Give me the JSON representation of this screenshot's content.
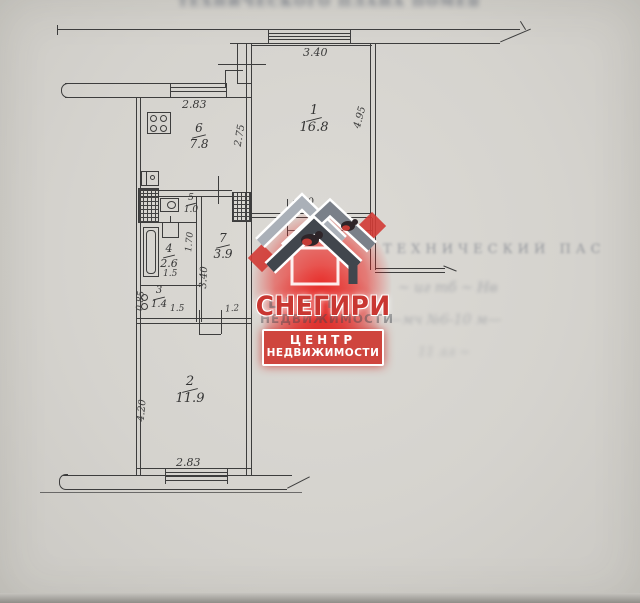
{
  "plan": {
    "rooms": {
      "r1": {
        "num": "1",
        "area": "16.8"
      },
      "r2": {
        "num": "2",
        "area": "11.9"
      },
      "r3": {
        "num": "3",
        "area": "1.4"
      },
      "r4": {
        "num": "4",
        "area": "2.6"
      },
      "r5": {
        "num": "5",
        "area": "1.0"
      },
      "r6": {
        "num": "6",
        "area": "7.8"
      },
      "r7": {
        "num": "7",
        "area": "3.9"
      }
    },
    "dims": {
      "balcony_top": "3.40",
      "kitchen_window": "2.83",
      "kitchen_wall": "2.75",
      "room1_side": "4.95",
      "room1_bottom": "3.70",
      "bath_side": "1.70",
      "bath_bottom": "1.5",
      "room3_side": "0.85",
      "room3_bottom": "1.5",
      "entry_width": "1.2",
      "hall_side": "3.40",
      "room2_side": "4.20",
      "room2_window": "2.83"
    }
  },
  "watermark": {
    "brand": "СНЕГИРИ",
    "tagline1": "ЦЕНТР",
    "tagline2": "НЕДВИЖИМОСТИ",
    "ghost_top": "ЦЕНТР",
    "ghost_mid": "НЕДВИЖИМОСТИ",
    "accent_red": "#d23b35",
    "roof_dark": "#41464d",
    "roof_mid": "#7a8089"
  },
  "bleedthrough": {
    "top_band": "ТЕХНИЧЕСКОГО ПЛАНА ПОМЕЩЕНИЯ",
    "right_title": "ТЕХНИЧЕСКИЙ ПАС",
    "scribble1": "~ иг тб ~ Нв",
    "scribble2": "—мч №6-10 м—",
    "scribble3": "11 лл ~"
  }
}
